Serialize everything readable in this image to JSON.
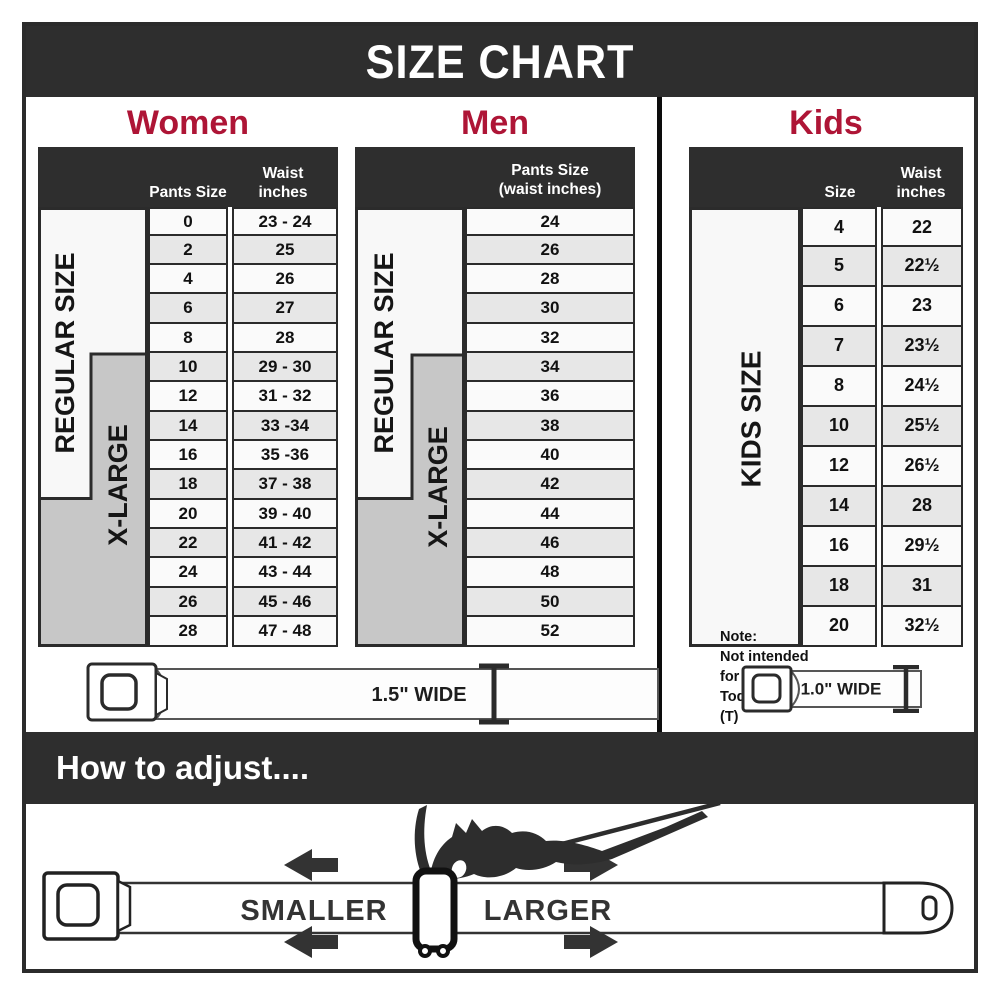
{
  "title": "SIZE CHART",
  "sections": {
    "women": {
      "heading": "Women",
      "header": {
        "size": "Pants Size",
        "waist_line1": "Waist",
        "waist_line2": "inches"
      },
      "regular_label": "REGULAR SIZE",
      "xlarge_label": "X-LARGE",
      "rows": [
        {
          "size": "0",
          "waist": "23 - 24"
        },
        {
          "size": "2",
          "waist": "25"
        },
        {
          "size": "4",
          "waist": "26"
        },
        {
          "size": "6",
          "waist": "27"
        },
        {
          "size": "8",
          "waist": "28"
        },
        {
          "size": "10",
          "waist": "29 - 30"
        },
        {
          "size": "12",
          "waist": "31 - 32"
        },
        {
          "size": "14",
          "waist": "33 -34"
        },
        {
          "size": "16",
          "waist": "35 -36"
        },
        {
          "size": "18",
          "waist": "37 - 38"
        },
        {
          "size": "20",
          "waist": "39 - 40"
        },
        {
          "size": "22",
          "waist": "41 - 42"
        },
        {
          "size": "24",
          "waist": "43 - 44"
        },
        {
          "size": "26",
          "waist": "45 - 46"
        },
        {
          "size": "28",
          "waist": "47 - 48"
        }
      ]
    },
    "men": {
      "heading": "Men",
      "header": {
        "line1": "Pants Size",
        "line2": "(waist inches)"
      },
      "regular_label": "REGULAR SIZE",
      "xlarge_label": "X-LARGE",
      "rows": [
        "24",
        "26",
        "28",
        "30",
        "32",
        "34",
        "36",
        "38",
        "40",
        "42",
        "44",
        "46",
        "48",
        "50",
        "52"
      ]
    },
    "kids": {
      "heading": "Kids",
      "header": {
        "size": "Size",
        "waist_line1": "Waist",
        "waist_line2": "inches"
      },
      "kids_label": "KIDS SIZE",
      "note": {
        "line1": "Note:",
        "line2": "Not intended for",
        "line3": "Toddler Sizes (T)"
      },
      "rows": [
        {
          "size": "4",
          "waist": "22"
        },
        {
          "size": "5",
          "waist": "22½"
        },
        {
          "size": "6",
          "waist": "23"
        },
        {
          "size": "7",
          "waist": "23½"
        },
        {
          "size": "8",
          "waist": "24½"
        },
        {
          "size": "10",
          "waist": "25½"
        },
        {
          "size": "12",
          "waist": "26½"
        },
        {
          "size": "14",
          "waist": "28"
        },
        {
          "size": "16",
          "waist": "29½"
        },
        {
          "size": "18",
          "waist": "31"
        },
        {
          "size": "20",
          "waist": "32½"
        }
      ]
    }
  },
  "belts": {
    "adult_width_label": "1.5\" WIDE",
    "kids_width_label": "1.0\" WIDE"
  },
  "adjust": {
    "heading": "How to adjust....",
    "smaller_label": "SMALLER",
    "larger_label": "LARGER"
  },
  "colors": {
    "bar_dark": "#2e2e2e",
    "accent_red": "#ae1536",
    "xlarge_gray": "#c7c7c7",
    "row_shaded": "#e7e7e7",
    "row_light": "#fafafa",
    "border_dark": "#2b2b2b"
  }
}
